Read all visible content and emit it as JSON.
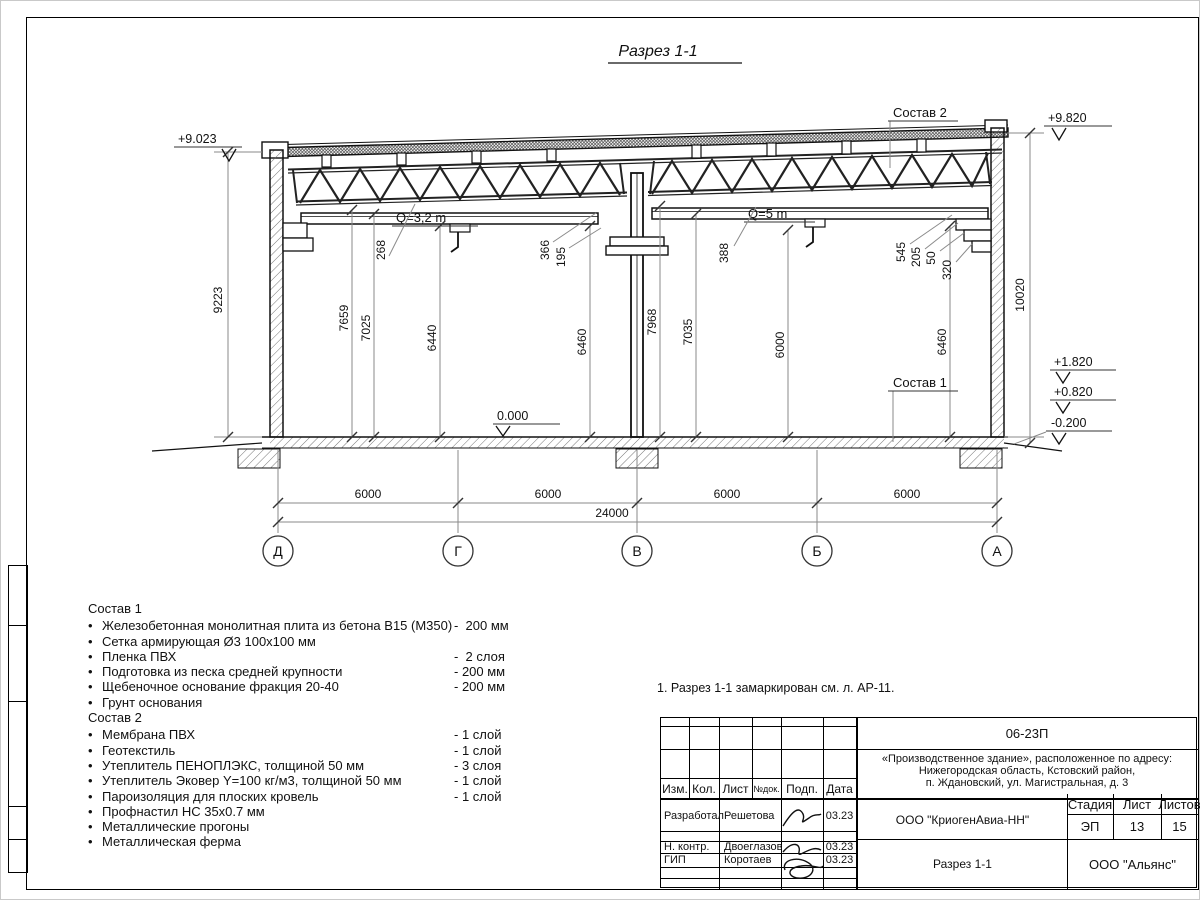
{
  "drawing_title": "Разрез 1-1",
  "section": {
    "elevations": {
      "top_left": "+9.023",
      "top_right": "+9.820",
      "floor": "0.000",
      "right_1": "+1.820",
      "right_2": "+0.820",
      "right_3": "-0.200"
    },
    "cranes": {
      "left": "Q=3,2 m",
      "right": "Q=5 m"
    },
    "callouts": {
      "comp2": "Состав 2",
      "comp1": "Состав 1"
    },
    "dims": {
      "h_left_outer": "9223",
      "h_right_outer": "10020",
      "d268": "268",
      "d7659": "7659",
      "d7025": "7025",
      "d6440": "6440",
      "d366": "366",
      "d195": "195",
      "d6460_left": "6460",
      "d388": "388",
      "d7968": "7968",
      "d7035": "7035",
      "d6000_mid": "6000",
      "d545": "545",
      "d205": "205",
      "d50": "50",
      "d320": "320",
      "d6460_right": "6460"
    },
    "spans": [
      "6000",
      "6000",
      "6000",
      "6000"
    ],
    "total_span": "24000",
    "axes": [
      "Д",
      "Г",
      "В",
      "Б",
      "А"
    ]
  },
  "comp1": {
    "title": "Состав 1",
    "items": [
      {
        "name": "Железобетонная монолитная плита из бетона В15 (М350)",
        "value": "-  200 мм"
      },
      {
        "name": "Сетка армирующая Ø3 100х100 мм",
        "value": ""
      },
      {
        "name": "Пленка ПВХ",
        "value": "-  2 слоя"
      },
      {
        "name": "Подготовка из песка средней крупности",
        "value": "- 200 мм"
      },
      {
        "name": "Щебеночное основание фракция 20-40",
        "value": "- 200 мм"
      },
      {
        "name": "Грунт основания",
        "value": ""
      }
    ]
  },
  "comp2": {
    "title": "Состав 2",
    "items": [
      {
        "name": "Мембрана ПВХ",
        "value": "- 1 слой"
      },
      {
        "name": "Геотекстиль",
        "value": "- 1 слой"
      },
      {
        "name": "Утеплитель ПЕНОПЛЭКС, толщиной 50 мм",
        "value": "- 3 слоя"
      },
      {
        "name": "Утеплитель Эковер Y=100 кг/м3, толщиной 50 мм",
        "value": "- 1 слой"
      },
      {
        "name": "Пароизоляция для плоских кровель",
        "value": "- 1 слой"
      },
      {
        "name": "Профнастил НС 35х0.7 мм",
        "value": ""
      },
      {
        "name": "Металлические прогоны",
        "value": ""
      },
      {
        "name": "Металлическая ферма",
        "value": ""
      }
    ]
  },
  "note": "1. Разрез 1-1 замаркирован см. л. АР-11.",
  "titleblock": {
    "code": "06-23П",
    "project_line1": "«Производственное здание», расположенное по адресу:",
    "project_line2": "Нижегородская область, Кстовский район,",
    "project_line3": "п. Ждановский, ул. Магистральная, д. 3",
    "col_izm": "Изм.",
    "col_kol": "Кол.",
    "col_list": "Лист",
    "col_ndok": "№док.",
    "col_podp": "Подп.",
    "col_data": "Дата",
    "row1_role": "Разработал",
    "row1_name": "Решетова",
    "row1_date": "03.23",
    "row2_role": "Н. контр.",
    "row2_name": "Двоеглазов",
    "row2_date": "03.23",
    "row3_role": "ГИП",
    "row3_name": "Коротаев",
    "row3_date": "03.23",
    "org": "ООО \"КриогенАвиа-НН\"",
    "stage_label": "Стадия",
    "sheet_label": "Лист",
    "sheets_label": "Листов",
    "stage": "ЭП",
    "sheet": "13",
    "sheets": "15",
    "doc_title": "Разрез 1-1",
    "company": "ООО \"Альянс\""
  }
}
